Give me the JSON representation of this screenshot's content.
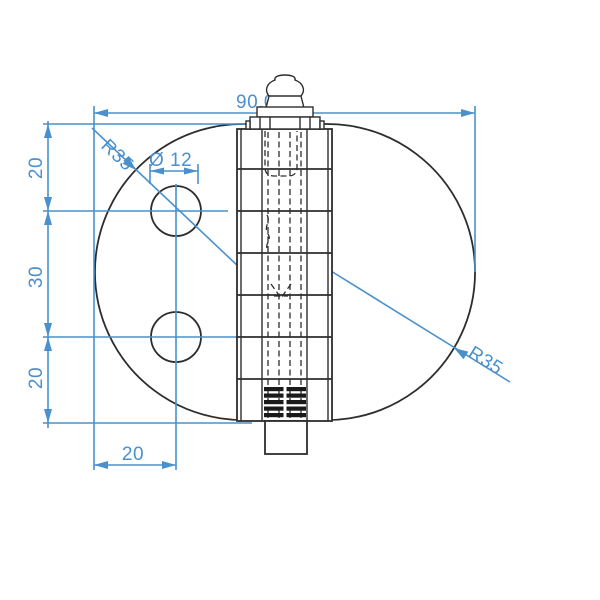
{
  "drawing": {
    "part": "hinge with grease fitting",
    "dimensions": {
      "overall_width": "90,0",
      "radius_left": "R35",
      "radius_right": "R35",
      "hole_diameter": "Ø 12",
      "top_edge_to_upper_hole": "20",
      "hole_spacing": "30",
      "lower_hole_to_bottom_edge": "20",
      "left_edge_to_hole_center": "20"
    },
    "colors": {
      "dimension": "#4a90cc",
      "geometry": "#2d2d2d",
      "background": "#ffffff"
    }
  }
}
